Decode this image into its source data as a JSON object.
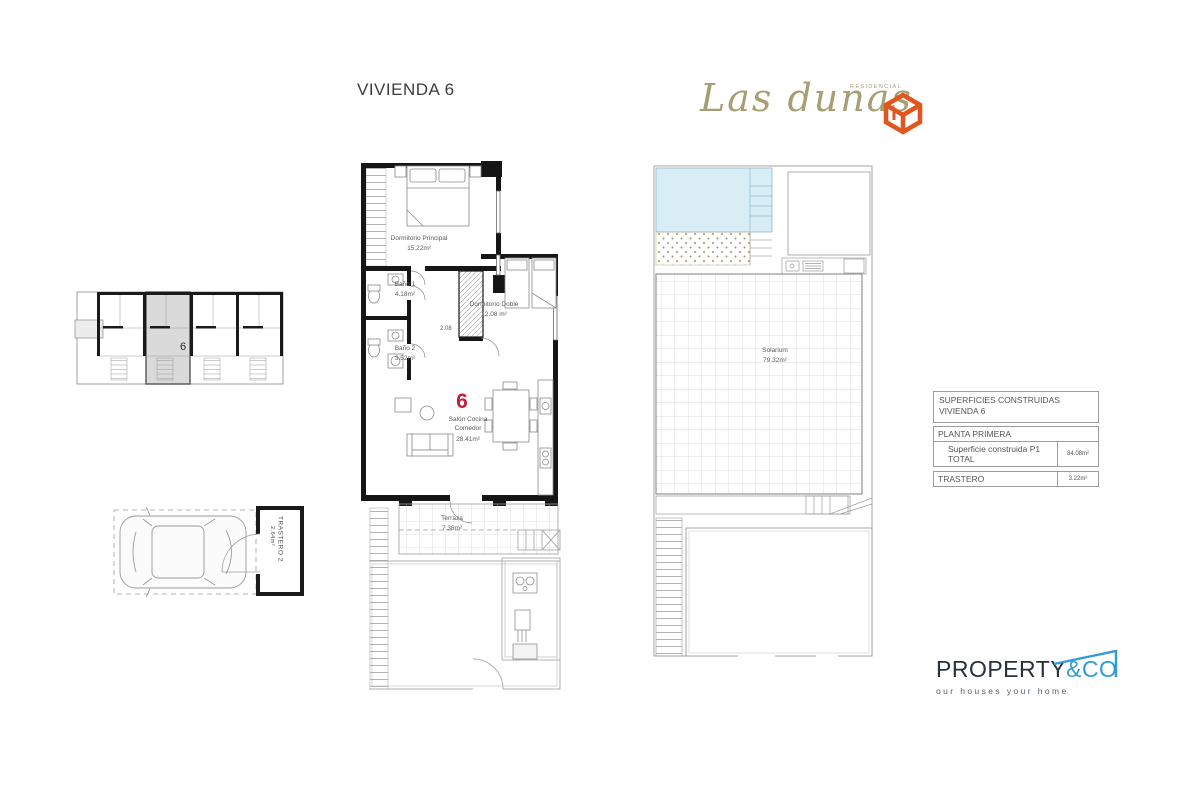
{
  "page": {
    "title": "VIVIENDA 6"
  },
  "brand": {
    "name": "Las dunas",
    "residencial": "RESIDENCIAL"
  },
  "key_plan": {
    "unit_label": "6"
  },
  "parking": {
    "storage_name": "TRASTERO 2",
    "storage_area": "2.64m²"
  },
  "main_plan": {
    "unit_number": "6",
    "dim_label": "2.08",
    "rooms": {
      "principal": {
        "name": "Dormitorio Principal",
        "area": "15.22m²"
      },
      "bano1": {
        "name": "Baño 1",
        "area": "4.18m²"
      },
      "bano2": {
        "name": "Baño 2",
        "area": "3.52m²"
      },
      "doble": {
        "name": "Dormitorio Doble",
        "area": "12.08 m²"
      },
      "salon": {
        "name": "Salón Cocina Comedor",
        "area": "28.41m²"
      },
      "terraza": {
        "name": "Terraza",
        "area": "7.38m²"
      }
    }
  },
  "solarium": {
    "name": "Solarium",
    "area": "79.32m²"
  },
  "areas_table": {
    "title_line1": "SUPERFICIES CONSTRUIDAS",
    "title_line2": "VIVIENDA 6",
    "section": "PLANTA PRIMERA",
    "rows": [
      {
        "label": "Superficie construida P1 TOTAL",
        "value": "84.08m²"
      },
      {
        "label": "TRASTERO",
        "value": "3.22m²"
      }
    ]
  },
  "footer_brand": {
    "main": "PROPERTY",
    "suffix": "&CO",
    "tagline": "our houses your home"
  },
  "colors": {
    "unit_red": "#c2203a",
    "brand_taupe": "#a89e74",
    "logo_orange": "#e0561f",
    "footer_navy": "#25313d",
    "footer_blue": "#2f9cd8",
    "pool_blue": "#d9edf6"
  }
}
